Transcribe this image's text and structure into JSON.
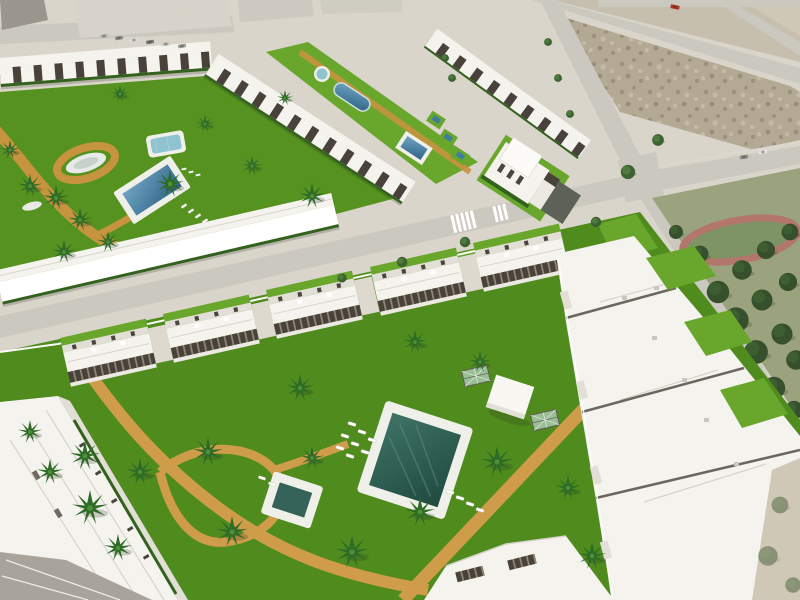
{
  "meta": {
    "type": "aerial-architectural-render",
    "description": "Aerial 3D render of a new-build coastal residential development: white townhouse rows with dark pergolas around communal gardens with swimming pools and palm trees, a large foreground complex with a dark teal pool and winding tan paths, vacant dirt plots, perimeter roads with crosswalks and cars, and a pine park with an oval track."
  },
  "colors": {
    "ground": "#d9d5cb",
    "road": "#cbc8bf",
    "sidewalk": "#dcd8cf",
    "dirt": "#b3a995",
    "dirtSpeck1": "#9a9078",
    "dirtSpeck2": "#c4bba6",
    "dirtLight": "#c6bfae",
    "dirtPale": "#cfc8b6",
    "lawn": "#55921f",
    "lawn2": "#4f8c1d",
    "lawn3": "#68a62c",
    "parkGrass": "#9aa37e",
    "parkGrass2": "#7e9465",
    "track": "#b3766b",
    "tree": "#3e6132",
    "treeLight": "#558441",
    "treeDark": "#364f2c",
    "palm": "#2e6b26",
    "palmLight": "#4e8f38",
    "trunk": "#8a6b46",
    "bldg": "#f4f3ee",
    "bldgShade": "#e2dfd7",
    "bldgEdge": "#ece9e2",
    "roofRidge": "#d8d4ca",
    "pergola": "#49423a",
    "rafter": "#968c7c",
    "hedge": "#33611e",
    "windows": "#4a463f",
    "pool": "#3f7d9e",
    "poolLight": "#8fc3cf",
    "pool1Hi": "#6fa3c0",
    "pool1Lo": "#2f6388",
    "pool2Hi": "#3f7265",
    "pool2Lo": "#1f4a40",
    "pool2b": "#35635a",
    "deck": "#eef0e9",
    "pond": "#e7eae6",
    "pondInner": "#c6d1cb",
    "path": "#c6933f",
    "path2": "#cf9c4a",
    "wallWhite": "#fafaf8",
    "white": "#ffffff",
    "terraceGray": "#a8a49b",
    "carRed": "#b23527",
    "carGrays": [
      "#b9b9b6",
      "#8e8e8c",
      "#ddddd9",
      "#7a7a78",
      "#c9c9c6",
      "#9f9f9c"
    ],
    "shadow": "rgba(45,48,38,0.22)",
    "glassFill": "rgba(205,224,232,0.6)",
    "glassFrame": "#5f594f"
  },
  "scene": {
    "existing_town": {
      "label": "existing-town-blocks",
      "parked_cars": 6
    },
    "vacant_lots": {
      "label": "vacant-dirt-plots",
      "plots": 3
    },
    "roads": {
      "label": "perimeter-roads",
      "crosswalks": 2,
      "cars_on_road": 3,
      "red_van": 1
    },
    "park": {
      "label": "pine-park",
      "feature": "oval-track",
      "trees": 14
    },
    "phase1": {
      "label": "upper-residential-complex",
      "townhouse_rows": 4,
      "water_features": [
        "rectangular-pool",
        "kids-pool",
        "white-pond",
        "round-fountain",
        "organic-pool",
        "square-pool"
      ],
      "palms": 12,
      "sun_loungers": 7,
      "paths": "tan-sand-loops"
    },
    "villa": {
      "label": "detached-corner-villa"
    },
    "phase2": {
      "label": "foreground-residential-complex",
      "gabled_houses": 5,
      "apartment_wing_blocks": 4,
      "water_features": [
        "large-teal-pool",
        "plunge-pool"
      ],
      "palms": 17,
      "sun_loungers": 14,
      "features": [
        "winding-tan-path",
        "diagonal-boardwalk",
        "glass-pergolas",
        "white-kiosk",
        "corner-building",
        "private-lawns"
      ]
    }
  }
}
